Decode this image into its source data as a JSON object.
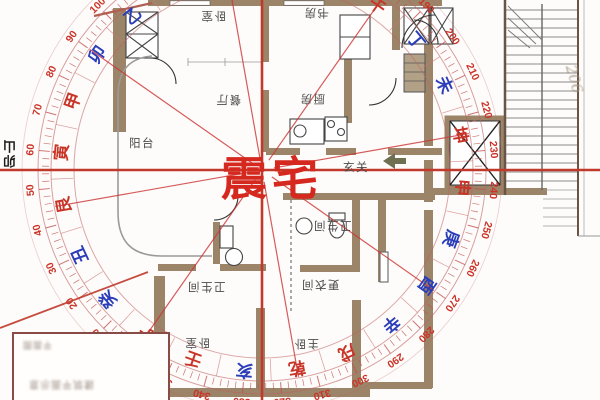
{
  "center_label": "震宅",
  "axis_label": "卯山",
  "handwritten_note": "206",
  "legend": {
    "blurred_caption_line1": "平面图",
    "blurred_caption_line2": "建筑平面示意"
  },
  "plan": {
    "rooms": [
      {
        "label": "卧室",
        "x": 213,
        "y": 16,
        "inverted": true
      },
      {
        "label": "书房",
        "x": 316,
        "y": 13,
        "inverted": true
      },
      {
        "label": "餐厅",
        "x": 228,
        "y": 100,
        "inverted": true
      },
      {
        "label": "厨房",
        "x": 312,
        "y": 99,
        "inverted": true
      },
      {
        "label": "阳台",
        "x": 142,
        "y": 143,
        "inverted": false
      },
      {
        "label": "玄关",
        "x": 356,
        "y": 167,
        "inverted": false
      },
      {
        "label": "卫生间",
        "x": 332,
        "y": 226,
        "inverted": true
      },
      {
        "label": "卫生间",
        "x": 206,
        "y": 287,
        "inverted": true
      },
      {
        "label": "更衣间",
        "x": 320,
        "y": 285,
        "inverted": true
      },
      {
        "label": "卧室",
        "x": 197,
        "y": 343,
        "inverted": true
      },
      {
        "label": "主卧",
        "x": 306,
        "y": 344,
        "inverted": true
      }
    ]
  },
  "compass": {
    "center": {
      "x": 262,
      "y": 170
    },
    "rotation_offset": -145,
    "degree_step": 10,
    "ring_color": "#c06060",
    "tick_color": "#c05050",
    "number_color": "#cc3328",
    "line_color": "#cc3333",
    "red": "#c93428",
    "blue": "#2b3db8",
    "circles": [
      {
        "r": 188,
        "w": 1,
        "o": 0.55
      },
      {
        "r": 211,
        "w": 1,
        "o": 0.6
      },
      {
        "r": 224,
        "w": 1,
        "o": 0.6
      },
      {
        "r": 240,
        "w": 0.8,
        "o": 0.3
      }
    ],
    "main_line_degrees": [
      0,
      45,
      90,
      135,
      180,
      225,
      270,
      315
    ],
    "mountains": [
      {
        "deg": 0,
        "char": "子",
        "color": "#c93428"
      },
      {
        "deg": 15,
        "char": "癸",
        "color": "#2b3db8"
      },
      {
        "deg": 30,
        "char": "丑",
        "color": "#2b3db8"
      },
      {
        "deg": 45,
        "char": "艮",
        "color": "#c93428"
      },
      {
        "deg": 60,
        "char": "寅",
        "color": "#c93428"
      },
      {
        "deg": 75,
        "char": "甲",
        "color": "#c93428"
      },
      {
        "deg": 90,
        "char": "卯",
        "color": "#2b3db8"
      },
      {
        "deg": 105,
        "char": "乙",
        "color": "#2b3db8"
      },
      {
        "deg": 120,
        "char": "辰",
        "color": "#c93428"
      },
      {
        "deg": 135,
        "char": "巽",
        "color": "#c93428"
      },
      {
        "deg": 150,
        "char": "巳",
        "color": "#2b3db8"
      },
      {
        "deg": 165,
        "char": "丙",
        "color": "#c93428"
      },
      {
        "deg": 180,
        "char": "午",
        "color": "#c93428"
      },
      {
        "deg": 195,
        "char": "丁",
        "color": "#2b3db8"
      },
      {
        "deg": 210,
        "char": "未",
        "color": "#2b3db8"
      },
      {
        "deg": 225,
        "char": "坤",
        "color": "#c93428"
      },
      {
        "deg": 240,
        "char": "申",
        "color": "#c93428"
      },
      {
        "deg": 255,
        "char": "庚",
        "color": "#2b3db8"
      },
      {
        "deg": 270,
        "char": "酉",
        "color": "#2b3db8"
      },
      {
        "deg": 285,
        "char": "辛",
        "color": "#2b3db8"
      },
      {
        "deg": 300,
        "char": "戌",
        "color": "#c93428"
      },
      {
        "deg": 315,
        "char": "乾",
        "color": "#c93428"
      },
      {
        "deg": 330,
        "char": "亥",
        "color": "#2b3db8"
      },
      {
        "deg": 345,
        "char": "壬",
        "color": "#c93428"
      }
    ]
  }
}
